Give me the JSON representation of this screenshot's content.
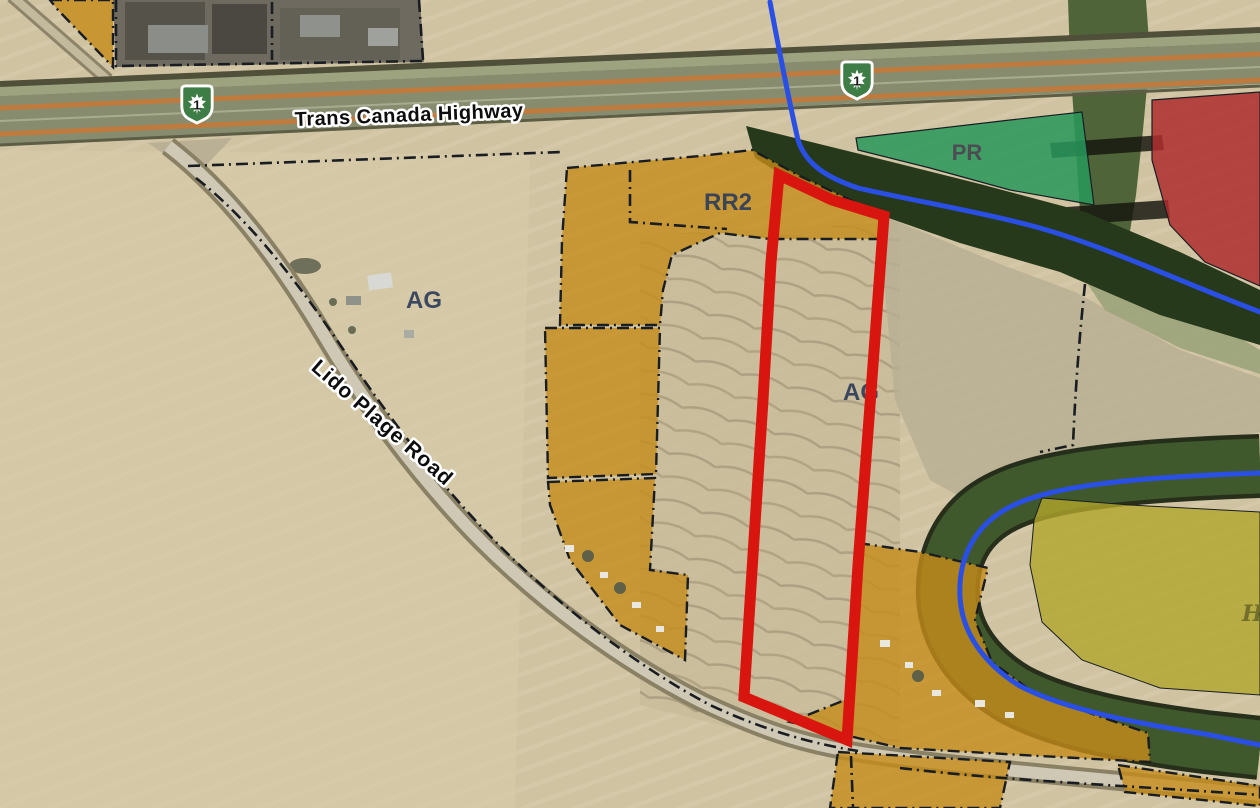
{
  "map": {
    "highway_label": "Trans Canada Highway",
    "road_label": "Lido Plage Road",
    "route_shield": {
      "number": "1"
    },
    "zone_labels": {
      "ag_west": "AG",
      "rr2": "RR2",
      "pr": "PR",
      "ag_central": "AG",
      "h_partial": "H"
    },
    "colors": {
      "parcel_outline_red": "#d8160f",
      "zone_residential_orange": "#c28c1e",
      "zone_park_green": "#27985a",
      "zone_red": "#ae2d2d",
      "zone_yellow_olive": "#b0a52c",
      "river_blue": "#2a4fe4",
      "riparian_trees_dark_green": "#263a1b",
      "boundary_dash_black": "#191d22",
      "shield_green": "#3e7d46",
      "highway_stripe_orange": "#bf7a3e"
    }
  }
}
